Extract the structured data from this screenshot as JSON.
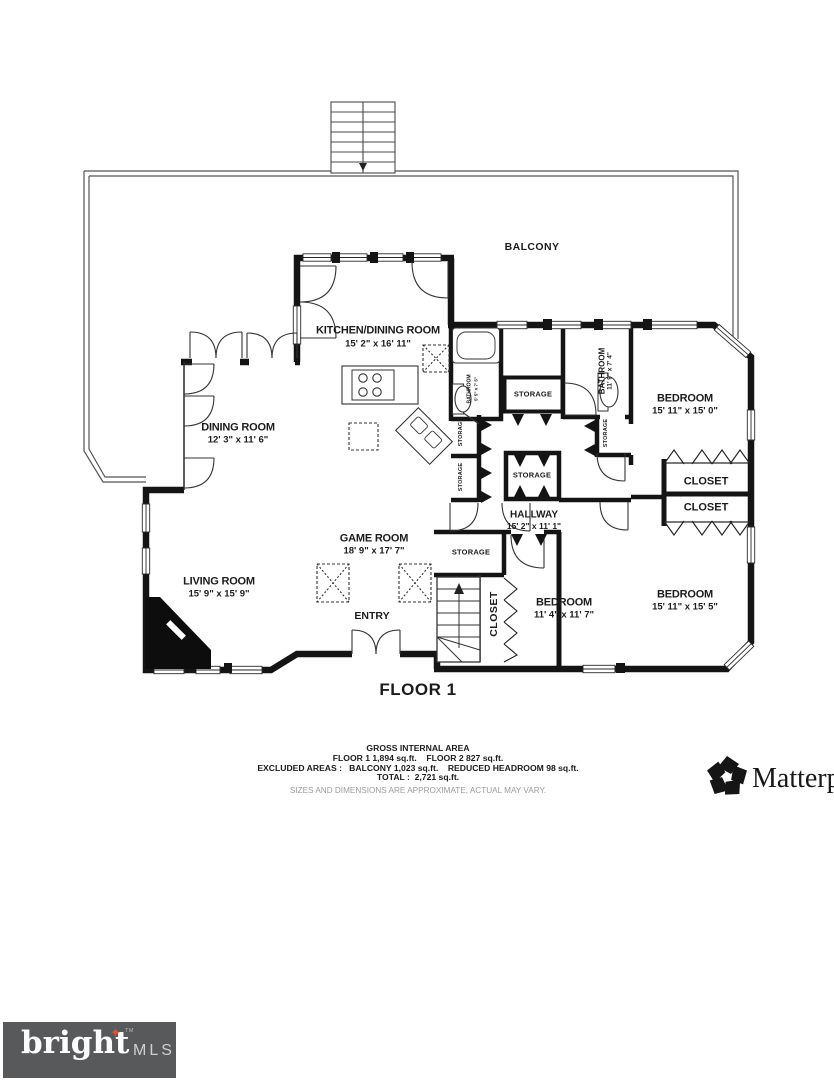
{
  "floor_plan": {
    "title": "FLOOR 1",
    "rooms": {
      "balcony": {
        "label": "BALCONY"
      },
      "kitchen_dining": {
        "label": "KITCHEN/DINING ROOM",
        "dims": "15' 2\" x 16' 11\""
      },
      "dining": {
        "label": "DINING ROOM",
        "dims": "12' 3\" x 11' 6\""
      },
      "living": {
        "label": "LIVING ROOM",
        "dims": "15' 9\" x 15' 9\""
      },
      "game": {
        "label": "GAME ROOM",
        "dims": "18' 9\" x 17' 7\""
      },
      "entry": {
        "label": "ENTRY"
      },
      "hallway": {
        "label": "HALLWAY",
        "dims": "15' 2\" x 11' 1\""
      },
      "bedroom_top_right": {
        "label": "BEDROOM",
        "dims": "15' 11\" x 15' 0\""
      },
      "bedroom_middle": {
        "label": "BEDROOM",
        "dims": "11' 4\" x 11' 7\""
      },
      "bedroom_bottom_right": {
        "label": "BEDROOM",
        "dims": "15' 11\" x 15' 5\""
      },
      "bathroom_small": {
        "label": "BATHROOM",
        "dims": "5' 5\" x 7' 5\""
      },
      "bathroom_large": {
        "label": "BATHROOM",
        "dims": "11' 9\" x 7' 4\""
      },
      "closet_upper": {
        "label": "CLOSET"
      },
      "closet_lower": {
        "label": "CLOSET"
      },
      "closet_bedroom_middle": {
        "label": "CLOSET"
      },
      "storage_hall_top": {
        "label": "STORAGE"
      },
      "storage_hall_center": {
        "label": "STORAGE"
      },
      "storage_bottom_left": {
        "label": "STORAGE"
      },
      "storage_niche_left_1": {
        "label": "STORAGE"
      },
      "storage_niche_left_2": {
        "label": "STORAGE"
      },
      "storage_niche_right": {
        "label": "STORAGE"
      }
    },
    "area_summary": {
      "heading": "GROSS INTERNAL AREA",
      "line1": "FLOOR 1 1,894 sq.ft.    FLOOR 2 827 sq.ft.",
      "line2": "EXCLUDED AREAS :   BALCONY 1,023 sq.ft.    REDUCED HEADROOM 98 sq.ft.",
      "line3": "TOTAL :  2,721 sq.ft.",
      "disclaimer": "SIZES AND DIMENSIONS ARE APPROXIMATE, ACTUAL MAY VARY."
    }
  },
  "branding": {
    "matterport": {
      "label": "Matterport"
    },
    "bright_mls": {
      "wordmark": "bright",
      "tm": "TM",
      "suffix": "MLS",
      "star_glyph": "✦",
      "box_color": "#58595b",
      "star_color": "#e0532f"
    }
  },
  "colors": {
    "plan_ink": "#141414",
    "paper": "#ffffff",
    "muted": "#9b9b9b"
  }
}
